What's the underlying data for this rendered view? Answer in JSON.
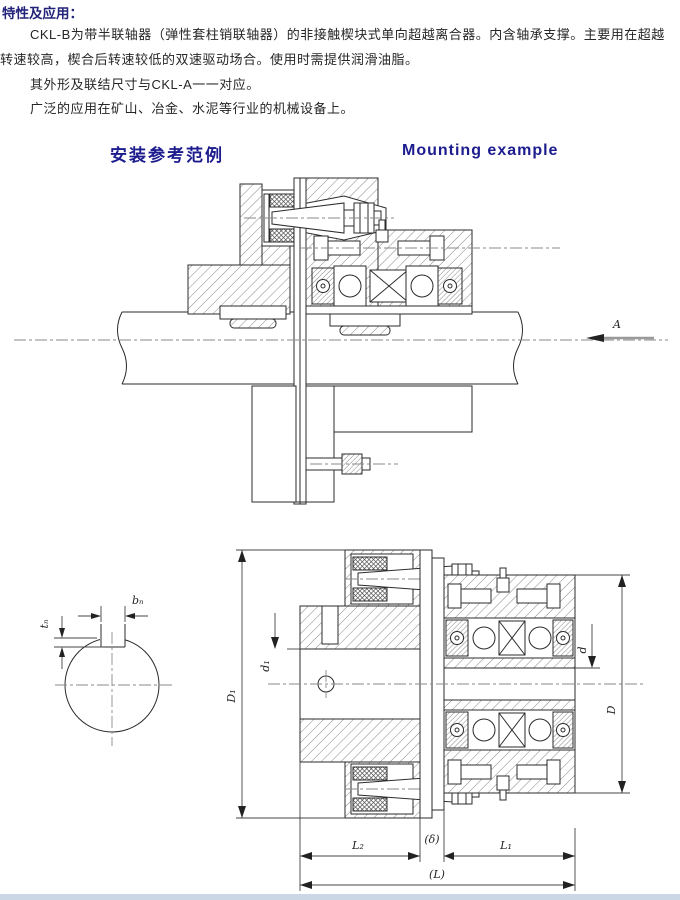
{
  "intro": {
    "title": "特性及应用：",
    "lines": [
      "CKL-B为带半联轴器（弹性套柱销联轴器）的非接触楔块式单向超越离合器。内含轴承支撑。主要用在超越",
      "转速较高，楔合后转速较低的双速驱动场合。使用时需提供润滑油脂。",
      "其外形及联结尺寸与CKL-A一一对应。",
      "广泛的应用在矿山、冶金、水泥等行业的机械设备上。"
    ]
  },
  "headings": {
    "cn": "安装参考范例",
    "en": "Mounting example"
  },
  "drawing1": {
    "view_arrow_label": "A"
  },
  "drawing2": {
    "keyway_width_label": "bₙ",
    "keyway_depth_label": "tₙ",
    "dim_flange_diameter": "D₁",
    "dim_bore_left": "d₁",
    "dim_bore_right": "d",
    "dim_clutch_diameter": "D",
    "dim_length_left": "L₂",
    "dim_gap": "(δ)",
    "dim_length_right": "L₁",
    "dim_length_total": "(L)"
  },
  "colors": {
    "heading_navy": "#1c1c8f",
    "body_text": "#262626",
    "line": "#2b2b2b",
    "footer_strip": "#ccd7e5"
  }
}
